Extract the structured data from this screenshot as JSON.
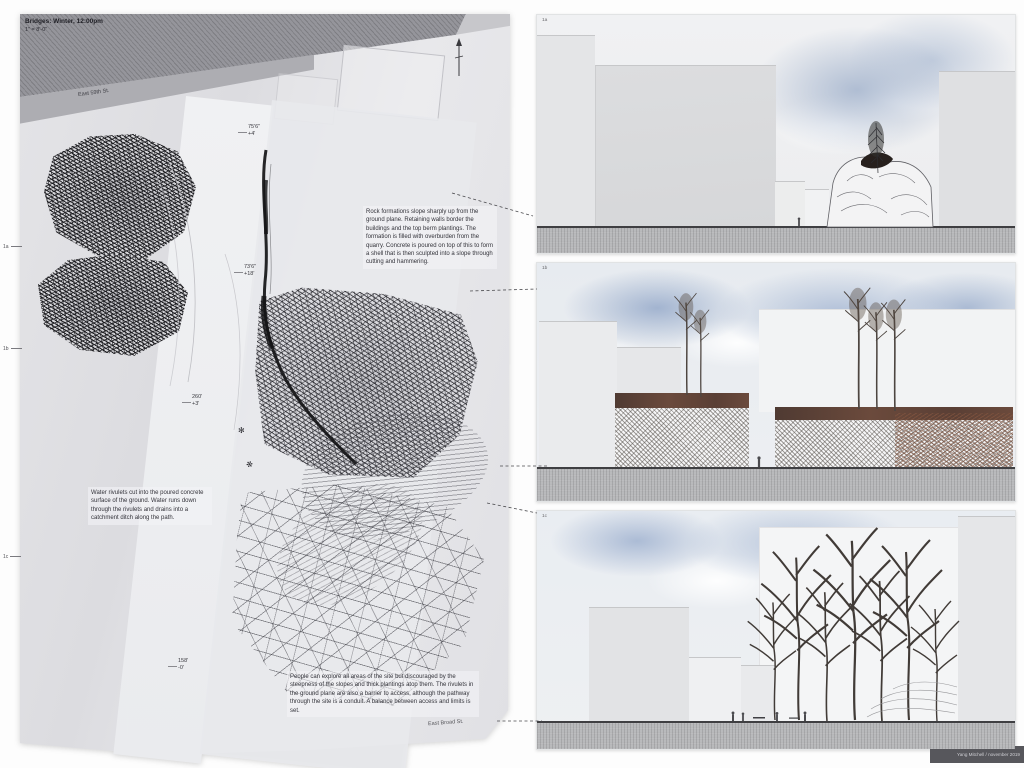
{
  "palette": {
    "band_gray": "#95959b",
    "paper_gray": "#e4e4e7",
    "sky_blue": "#a9bbd6",
    "soil_brown": "#5f4036",
    "ink": "#1c1c1f"
  },
  "plan": {
    "title": "Bridges: Winter, 12:00pm",
    "scale": "1\" = 8'-0\"",
    "street_top": "East 59th St.",
    "street_bottom": "East Broad St.",
    "notes": {
      "rock": "Rock formations slope sharply up from the ground plane. Retaining walls border the buildings and the top berm plantings. The formation is filled with overburden from the quarry. Concrete is poured on top of this to form a shell that is then sculpted into a slope through cutting and hammering.",
      "water": "Water rivulets cut into the poured concrete surface of the ground. Water runs down through the rivulets and drains into a catchment ditch along the path.",
      "access": "People can explore all areas of the site but discouraged by the steepness of the slopes and thick plantings atop them. The rivulets in the ground plane are also a barrier to access, although the pathway through the site is a conduit. A balance between access and limits is set."
    },
    "dims": [
      {
        "l1": "75'6\"",
        "l2": "+4'"
      },
      {
        "l1": "73'6\"",
        "l2": "+18'"
      },
      {
        "l1": "260'",
        "l2": "+3'"
      },
      {
        "l1": "158'",
        "l2": "-0'"
      }
    ],
    "markers": [
      {
        "label": "1a"
      },
      {
        "label": "1b"
      },
      {
        "label": "1c"
      }
    ],
    "glyphs": {
      "snowflake": "✻"
    }
  },
  "sections": [
    {
      "label": "1a"
    },
    {
      "label": "1b"
    },
    {
      "label": "1c"
    }
  ],
  "credit": {
    "text": "Yang Mitchell / november 2019"
  }
}
